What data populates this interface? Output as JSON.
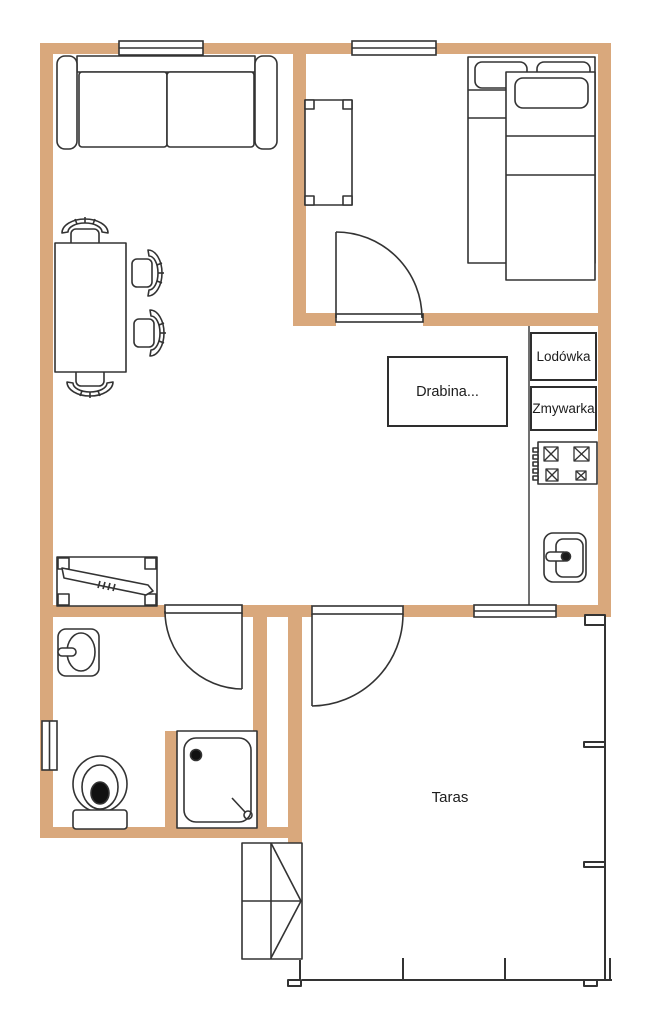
{
  "palette": {
    "wall_fill": "#D9A87C",
    "line": "#333333",
    "background": "#FFFFFF"
  },
  "labels": {
    "fridge": "Lodówka",
    "dishwasher": "Zmywarka",
    "ladder": "Drabina...",
    "terrace": "Taras"
  }
}
